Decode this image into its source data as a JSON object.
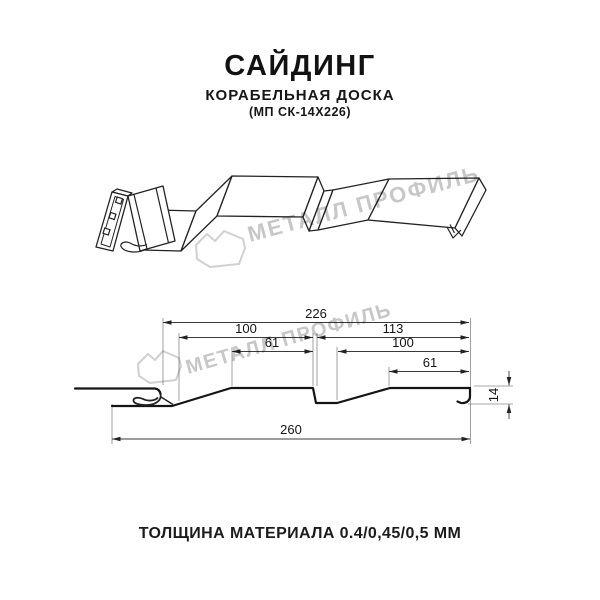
{
  "header": {
    "title": "САЙДИНГ",
    "subtitle": "КОРАБЕЛЬНАЯ ДОСКА",
    "model": "(МП СК-14Х226)"
  },
  "brand": {
    "watermark_text": "МЕТАЛЛ ПРОФИЛЬ",
    "watermark_color": "#c7c7c7"
  },
  "diagram": {
    "type": "siding-profile-cross-section",
    "dims": {
      "overall_top": "226",
      "board_left": "100",
      "flat_left": "61",
      "board_right": "113",
      "flat_right_inner": "100",
      "flat_right": "61",
      "overall_bottom": "260",
      "height": "14"
    }
  },
  "footer": {
    "thickness": "ТОЛЩИНА МАТЕРИАЛА 0.4/0,45/0,5 ММ"
  }
}
